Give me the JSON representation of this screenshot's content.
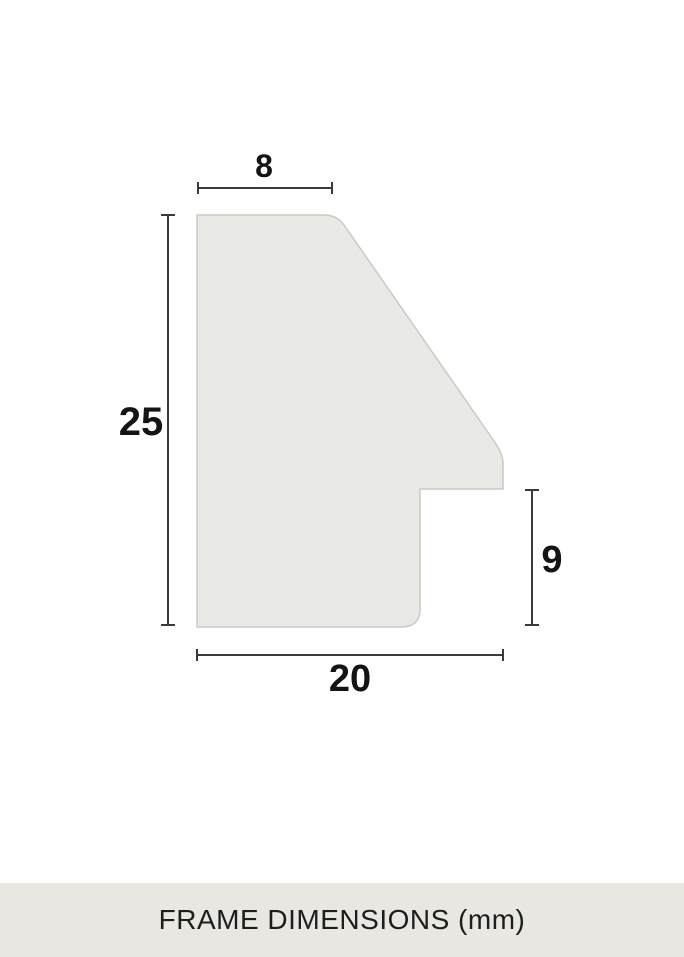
{
  "diagram": {
    "name": "frame-profile-cross-section",
    "dims": {
      "top": {
        "label": "8",
        "value": 8
      },
      "left": {
        "label": "25",
        "value": 25
      },
      "right": {
        "label": "9",
        "value": 9
      },
      "bottom": {
        "label": "20",
        "value": 20
      }
    }
  },
  "footer": {
    "caption": "FRAME DIMENSIONS (mm)"
  },
  "colors": {
    "background": "#ffffff",
    "shape_fill": "#e9e9e6",
    "shape_stroke": "#c9c9c6",
    "dimension_line": "#3a3a3a",
    "label_text": "#141414",
    "footer_band": "#e8e7e2",
    "footer_text": "#1e1e1e"
  }
}
